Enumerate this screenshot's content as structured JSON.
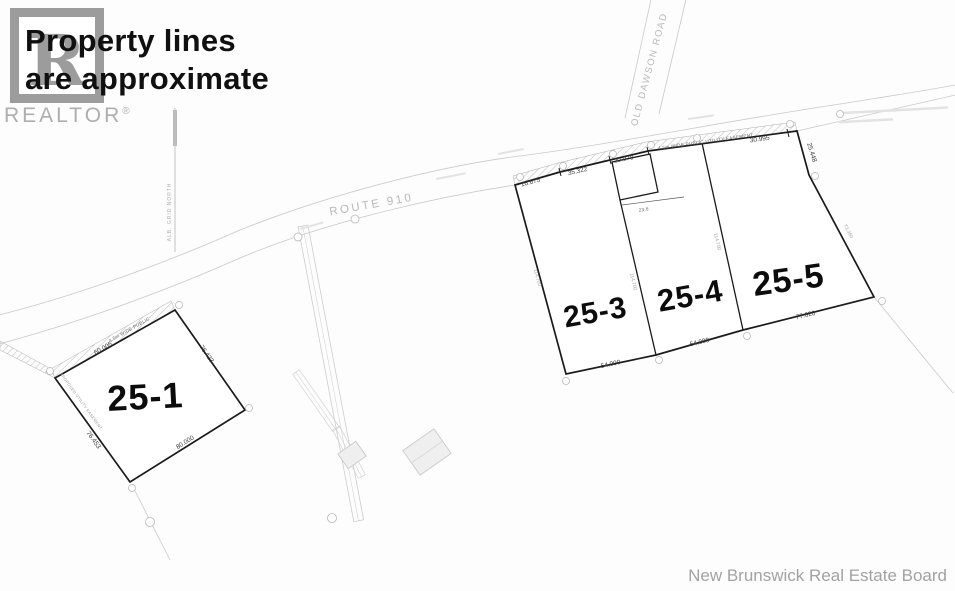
{
  "overlay": {
    "line1": "Property lines",
    "line2": "are approximate"
  },
  "branding": {
    "logo_letter": "R",
    "brand": "REALTOR",
    "registered": "®"
  },
  "attribution": "New Brunswick Real Estate Board",
  "roads": {
    "route_910": "ROUTE 910",
    "old_dawson_road": "OLD DAWSON ROAD",
    "grid_north": "ALB. GRID NORTH"
  },
  "easements": {
    "public_utility_full": "4.5m WIDE PUBLIC UTILITY EASEMENT",
    "public_utility_short": "4.5m WIDE PUBLIC",
    "proposed": "PROPOSED UTILITY EASEMENT"
  },
  "lots": {
    "lot_25_1": {
      "label": "25-1",
      "dim_top": "60.005",
      "dim_right": "76.423",
      "dim_bottom": "80.000",
      "dim_left": "76.453"
    },
    "lot_25_3": {
      "label": "25-3",
      "dim_bottom": "54.000"
    },
    "lot_25_4": {
      "label": "25-4",
      "dim_bottom": "54.000"
    },
    "lot_25_5": {
      "label": "25-5",
      "dim_bottom": "77.620",
      "dim_right_upper": "25.448",
      "dim_right_lower": "73.360"
    }
  },
  "frontage": {
    "seg1": "16.675",
    "seg2": "35.322",
    "seg3": "20.078",
    "seg4": "30.995"
  },
  "depths": {
    "d1": "114.700",
    "d2": "114.700",
    "d3": "114.700"
  },
  "well_lot": {
    "dim": "23.6"
  }
}
